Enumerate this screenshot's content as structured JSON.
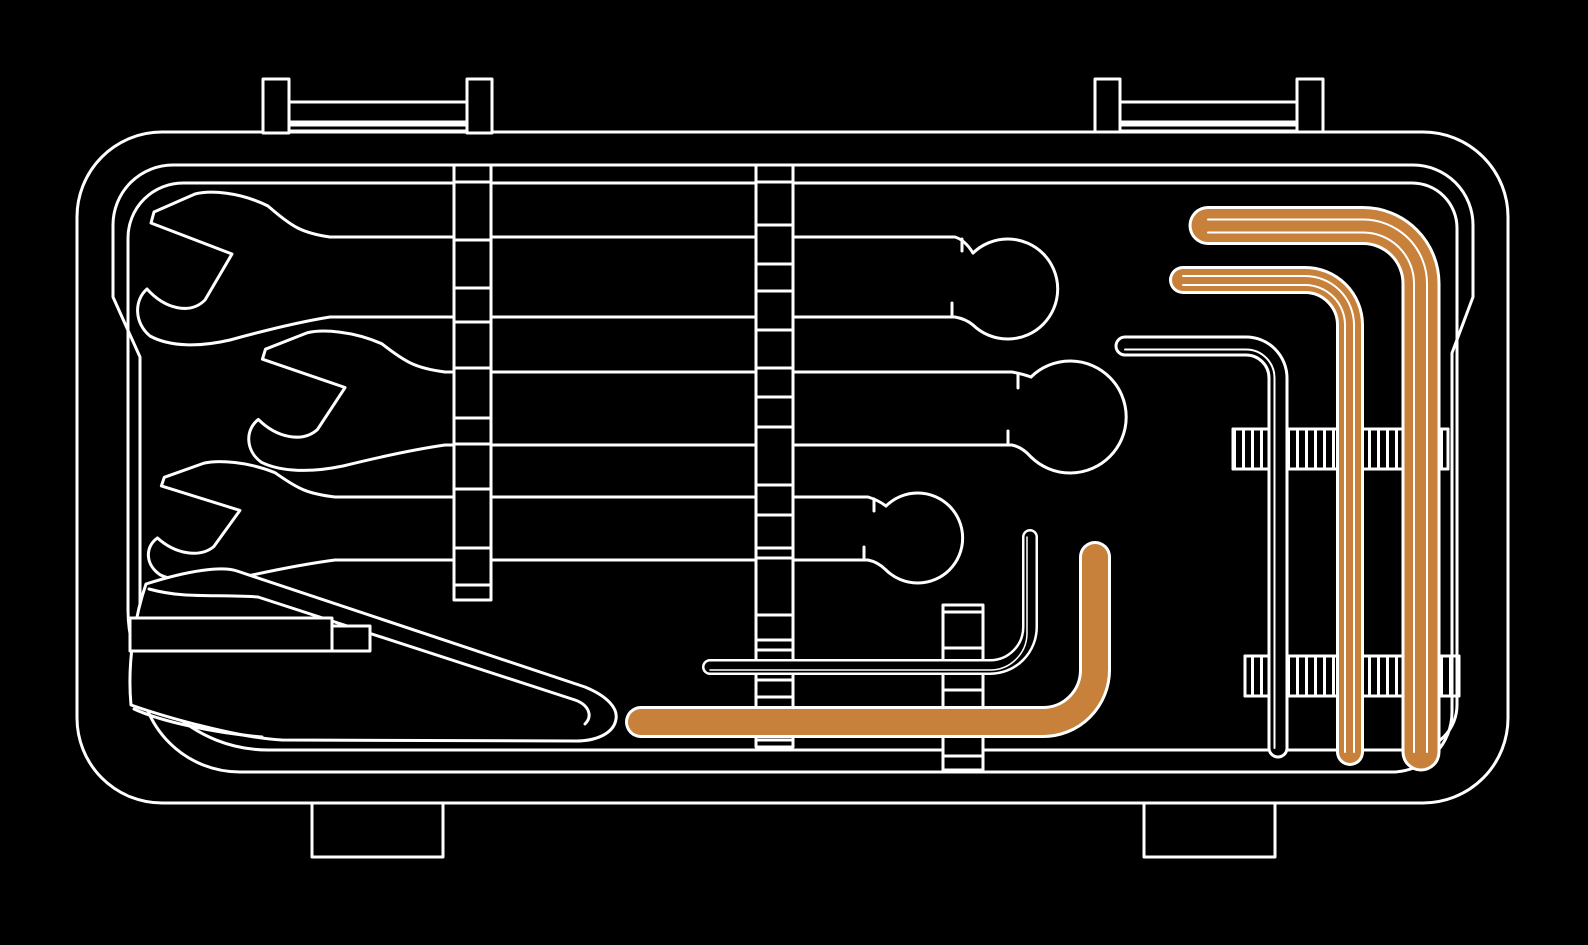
{
  "colors": {
    "background": "#000000",
    "line": "#ffffff",
    "accent": "#c7813b"
  },
  "illustration": {
    "name": "open-toolbox-with-tools",
    "items": [
      {
        "id": "toolbox-case",
        "label": "toolbox case",
        "color_ref": "line"
      },
      {
        "id": "handle-latch-left",
        "label": "left carry latch",
        "color_ref": "line"
      },
      {
        "id": "handle-latch-right",
        "label": "right carry latch",
        "color_ref": "line"
      },
      {
        "id": "foot-left",
        "label": "left foot",
        "color_ref": "line"
      },
      {
        "id": "foot-right",
        "label": "right foot",
        "color_ref": "line"
      },
      {
        "id": "combination-wrench-1",
        "label": "combination wrench (top)",
        "color_ref": "line"
      },
      {
        "id": "combination-wrench-2",
        "label": "combination wrench (middle)",
        "color_ref": "line"
      },
      {
        "id": "combination-wrench-3",
        "label": "combination wrench (bottom)",
        "color_ref": "line"
      },
      {
        "id": "pry-bar",
        "label": "pry bar",
        "color_ref": "line"
      },
      {
        "id": "strap-left",
        "label": "left retaining strap",
        "color_ref": "line"
      },
      {
        "id": "strap-middle",
        "label": "middle retaining strap",
        "color_ref": "line"
      },
      {
        "id": "strap-small",
        "label": "small retaining strap",
        "color_ref": "line"
      },
      {
        "id": "band-upper-right",
        "label": "upper hatched retaining band",
        "color_ref": "line"
      },
      {
        "id": "band-lower-right",
        "label": "lower hatched retaining band",
        "color_ref": "line"
      },
      {
        "id": "hex-key-large-orange",
        "label": "large hex key",
        "color_ref": "accent"
      },
      {
        "id": "hex-key-medium-orange",
        "label": "medium hex key",
        "color_ref": "accent"
      },
      {
        "id": "hex-key-steel-right",
        "label": "steel hex key (right)",
        "color_ref": "line"
      },
      {
        "id": "hex-key-bottom-orange",
        "label": "bottom hex key",
        "color_ref": "accent"
      },
      {
        "id": "hex-key-small-steel",
        "label": "small steel hex key (bottom)",
        "color_ref": "line"
      }
    ]
  }
}
